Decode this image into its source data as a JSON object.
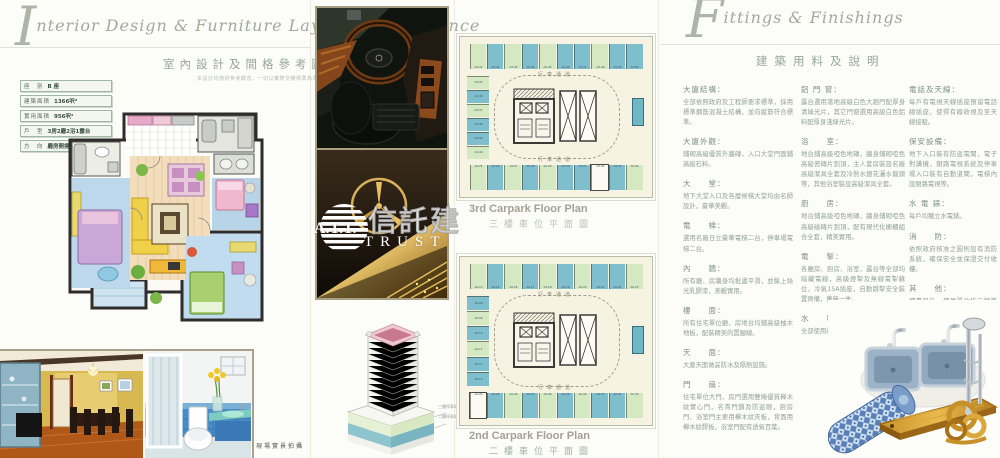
{
  "left_panel": {
    "title_initial": "I",
    "title_en": "nterior Design & Furniture Layout for Reference",
    "title_zh": "室內設計及間格參考圖",
    "disclaimer": "本設計均僅供參考概念，一切以實際交樓標準為準。",
    "specs": [
      {
        "label": "座　別",
        "value": "B 座"
      },
      {
        "label": "建築面積",
        "value": "1366呎²"
      },
      {
        "label": "實用面積",
        "value": "956呎²"
      },
      {
        "label": "戶　型",
        "value": "3房2廳2浴1露台"
      },
      {
        "label": "方　向",
        "value": "廳房開揚及伊甸綠化區"
      }
    ],
    "photo_caption": "現場實景拍攝"
  },
  "carpark": {
    "lane_label": "行車通道",
    "plans": [
      {
        "title_en": "3rd Carpark Floor Plan",
        "title_zh": "三樓車位平面圖",
        "top_stalls": [
          {
            "c": "g",
            "l": "A3-41"
          },
          {
            "c": "t",
            "l": "A3-42"
          },
          {
            "c": "g",
            "l": "A3-43"
          },
          {
            "c": "t",
            "l": "A3-44"
          },
          {
            "c": "g",
            "l": "A3-45"
          },
          {
            "c": "t",
            "l": "A3-46"
          },
          {
            "c": "t",
            "l": "A3-47"
          },
          {
            "c": "g",
            "l": "A3-48"
          },
          {
            "c": "t",
            "l": "A3-49"
          },
          {
            "c": "t",
            "l": "A3-50"
          }
        ],
        "left_stalls": [
          {
            "c": "g",
            "l": "A3-35"
          },
          {
            "c": "t",
            "l": "A3-36"
          },
          {
            "c": "g",
            "l": "A3-37"
          },
          {
            "c": "t",
            "l": "A3-38"
          },
          {
            "c": "t",
            "l": "A3-39"
          },
          {
            "c": "g",
            "l": "A3-40"
          }
        ],
        "bottom_stalls": [
          {
            "c": "g",
            "l": "A3-25"
          },
          {
            "c": "t",
            "l": "A3-26"
          },
          {
            "c": "g",
            "l": "A3-27"
          },
          {
            "c": "t",
            "l": "A3-28"
          },
          {
            "c": "g",
            "l": "A3-29"
          },
          {
            "c": "t",
            "l": "A3-30"
          },
          {
            "c": "t",
            "l": "A3-31"
          },
          {
            "c": "w",
            "l": "A3-32"
          },
          {
            "c": "t",
            "l": "A3-33"
          },
          {
            "c": "g",
            "l": "A3-34"
          }
        ]
      },
      {
        "title_en": "2nd Carpark Floor Plan",
        "title_zh": "二樓車位平面圖",
        "top_stalls": [
          {
            "c": "g",
            "l": "A2-14"
          },
          {
            "c": "t",
            "l": "A2-15"
          },
          {
            "c": "g",
            "l": "A2-16"
          },
          {
            "c": "t",
            "l": "A2-17"
          },
          {
            "c": "g",
            "l": "A2-18"
          },
          {
            "c": "t",
            "l": "A2-19"
          },
          {
            "c": "g",
            "l": "A2-20"
          },
          {
            "c": "t",
            "l": "A2-21"
          },
          {
            "c": "t",
            "l": "A2-22"
          },
          {
            "c": "g",
            "l": "A2-23"
          }
        ],
        "left_stalls": [
          {
            "c": "t",
            "l": "A2-08"
          },
          {
            "c": "g",
            "l": "A2-09"
          },
          {
            "c": "t",
            "l": "A2-10"
          },
          {
            "c": "g",
            "l": "A2-11"
          },
          {
            "c": "t",
            "l": "A2-12"
          },
          {
            "c": "t",
            "l": "A2-13"
          }
        ],
        "bottom_stalls": [
          {
            "c": "w",
            "l": "A2-24"
          },
          {
            "c": "t",
            "l": "A2-25"
          },
          {
            "c": "g",
            "l": "A2-26"
          },
          {
            "c": "t",
            "l": "A2-27"
          },
          {
            "c": "g",
            "l": "A2-28"
          },
          {
            "c": "t",
            "l": "A2-29"
          },
          {
            "c": "g",
            "l": "A2-30"
          },
          {
            "c": "t",
            "l": "A2-31"
          },
          {
            "c": "t",
            "l": "A2-32"
          },
          {
            "c": "g",
            "l": "A2-33"
          }
        ]
      }
    ]
  },
  "tower": {
    "label_3f": "三樓停車場",
    "label_2f": "二樓停車場"
  },
  "right_panel": {
    "title_initial": "F",
    "title_en": "ittings & Finishings",
    "title_zh": "建築用料及說明",
    "columns": [
      [
        {
          "h": "大廈結構：",
          "p": "全部依照政府及工程師要求標準，採用標準鋼筋混凝土結構，並向縱筋符合標準。"
        },
        {
          "h": "大廈外觀：",
          "p": "鋪砌高級優質外牆磚，入口大堂門面鋪高級石料。"
        },
        {
          "h": "大　　堂：",
          "p": "地下大堂入口及各層候梯大堂均由名師設計，豪華美觀。"
        },
        {
          "h": "電　　梯：",
          "p": "選用名廠日立豪華電梯二台，停車場電梯二台。"
        },
        {
          "h": "內　　牆：",
          "p": "所有廳、房牆身均批盪平滑，並髹上絲光乳膠漆，美觀實用。"
        },
        {
          "h": "樓　　面：",
          "p": "所有住宅單位廳、房地台均鋪高級柚木地板，配裝精美的置腳線。"
        },
        {
          "h": "天　　面：",
          "p": "大廈天面做妥防水及隔熱設施。"
        },
        {
          "h": "門　　扇：",
          "p": "住宅單位大門、房門選用雙掩優質櫸木紋實心門，名貴門鎖及防盜眼，廚房門、浴室門主要用櫸木紋夾板，背面用櫸木紋膠板，浴室門配有透氣百葉。"
        }
      ],
      [
        {
          "h": "鋁 門 窗：",
          "p": "露台選用落地高級白色大趟門配厚身清綠光片，其它門窗選用高級白色鋁料配厚身淺綠光片。"
        },
        {
          "h": "浴　　室：",
          "p": "地台鋪高級啞色地磚，牆身鋪砌啞色高級瓷磚片到頂，主人套房裝設名廠高級潔具全套及冷熱水銀花灑水龍頭等，其他浴室裝設高級潔具全套。"
        },
        {
          "h": "廚　　房：",
          "p": "地台鋪高級啞色地磚，牆身鋪砌啞色高級磁磚片到頂，配有現代化櫥櫃組合全套，精美實用。"
        },
        {
          "h": "電　　掣：",
          "p": "各廳房、廚房、浴室、露台等全部均暗藏電線，高級燈掣及無線電掣蘇位，冷氣15A插座，自動跳掣安全裝置齊備，萬無一失。"
        },
        {
          "h": "水　　喉：",
          "p": "全部使用新型鍍鋅喉管，衛浴設備。"
        }
      ],
      [
        {
          "h": "電話及天線：",
          "p": "每戶有電視天線插座預留電話線插座，使得有線收視及至天線接駁。"
        },
        {
          "h": "保安設備：",
          "p": "地下入口裝有防盜電閘，電子對講機，閉路電視系統及停車場入口裝有自動道閘，電梯內設閉路電視等。"
        },
        {
          "h": "水 電 錶：",
          "p": "每戶均獨立水電錶。"
        },
        {
          "h": "消　　防：",
          "p": "依照政府核准之圖則設有消防系統，確保安全並保證交付收樓。"
        },
        {
          "h": "其　　他：",
          "p": "樓書設計、樓層單位指示牌等一應俱全。"
        }
      ]
    ]
  },
  "watermark": {
    "initials": "A.T.T.",
    "zh": "信託建",
    "en": "TRUST"
  },
  "colors": {
    "stall_teal": "#7fbfcd",
    "stall_green": "#d4e9c2",
    "plan_bg": "#f6f3e3",
    "frame_tan": "#a8a083",
    "accent_gold": "#d8a030"
  }
}
